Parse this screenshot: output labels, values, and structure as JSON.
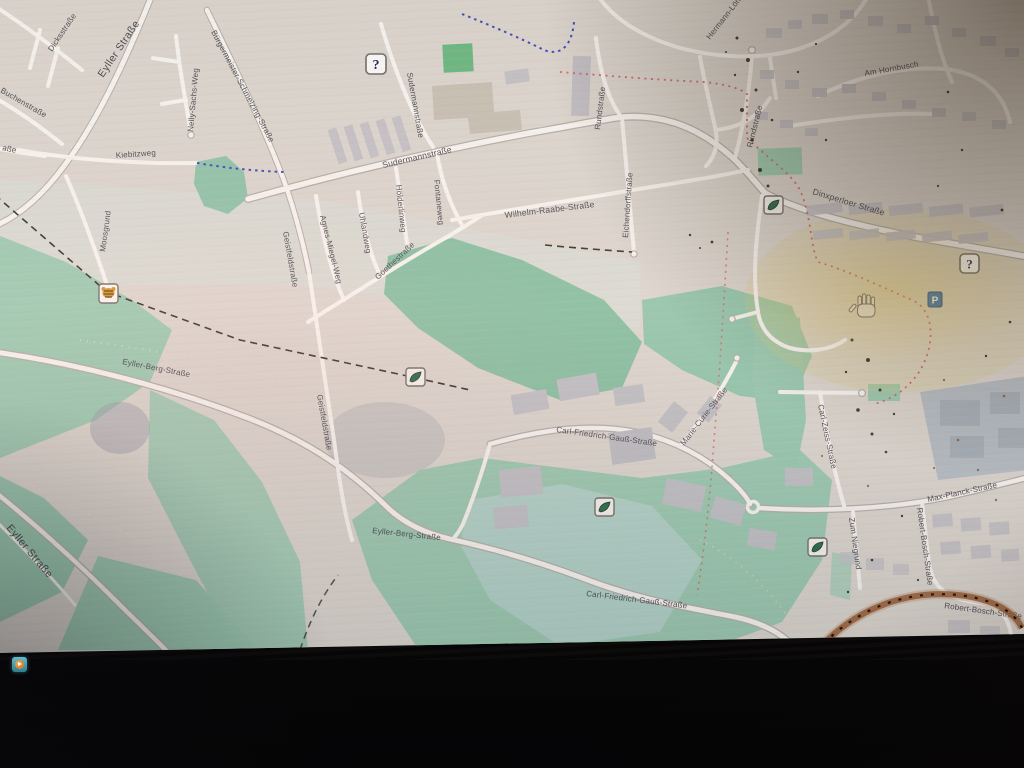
{
  "map": {
    "street_labels": [
      {
        "text": "Dicksstraße"
      },
      {
        "text": "Eyller Straße"
      },
      {
        "text": "Buchenstraße"
      },
      {
        "text": "aße"
      },
      {
        "text": "Nelly-Sachs-Weg"
      },
      {
        "text": "Bürgermeister-Schmelzing-Straße"
      },
      {
        "text": "Kiebitzweg"
      },
      {
        "text": "Moosgrund"
      },
      {
        "text": "Sudermannstraße"
      },
      {
        "text": "Sudermannstraße"
      },
      {
        "text": "Wilhelm-Raabe-Straße"
      },
      {
        "text": "Rundstraße"
      },
      {
        "text": "Rundstraße"
      },
      {
        "text": "Eichendorffstraße"
      },
      {
        "text": "Hölderlinweg"
      },
      {
        "text": "Uhlandweg"
      },
      {
        "text": "Agnes-Miegel-Weg"
      },
      {
        "text": "Fontaneweg"
      },
      {
        "text": "Goethestraße"
      },
      {
        "text": "Geistfeldstraße"
      },
      {
        "text": "Geistfeldstraße"
      },
      {
        "text": "Hermann-Löns-Straße"
      },
      {
        "text": "Am Hornbusch"
      },
      {
        "text": "Dinxperloer Straße"
      },
      {
        "text": "Eyller-Berg-Straße"
      },
      {
        "text": "Eyller-Berg-Straße"
      },
      {
        "text": "Carl-Friedrich-Gauß-Straße"
      },
      {
        "text": "Carl-Friedrich-Gauß-Straße"
      },
      {
        "text": "Marie-Curie-Straße"
      },
      {
        "text": "Carl-Zeiss-Straße"
      },
      {
        "text": "Max-Planck-Straße"
      },
      {
        "text": "Zum Niegrund"
      },
      {
        "text": "Robert-Bosch-Straße"
      },
      {
        "text": "Robert-Bosch-Straße"
      },
      {
        "text": "Eyller Straße"
      }
    ],
    "poi": {
      "help_glyph": "?",
      "parking_glyph": "P"
    },
    "colors": {
      "map_base": "#ddd9d2",
      "landuse_green": "#9ecfb6",
      "pitch_green": "#69be82",
      "water_teal": "#b6d8d2",
      "road_fill": "#f9f7f3",
      "road_casing": "#b6b3ad",
      "building_gray": "#c6c5ca",
      "boundary_red": "#d96d6d",
      "path_blue": "#3c50cc",
      "label_gray": "#45454d",
      "smudge_arc": "#9c5a2e",
      "taskbar_teal": "#4aa3b5",
      "taskbar_orange": "#d98a33"
    }
  }
}
